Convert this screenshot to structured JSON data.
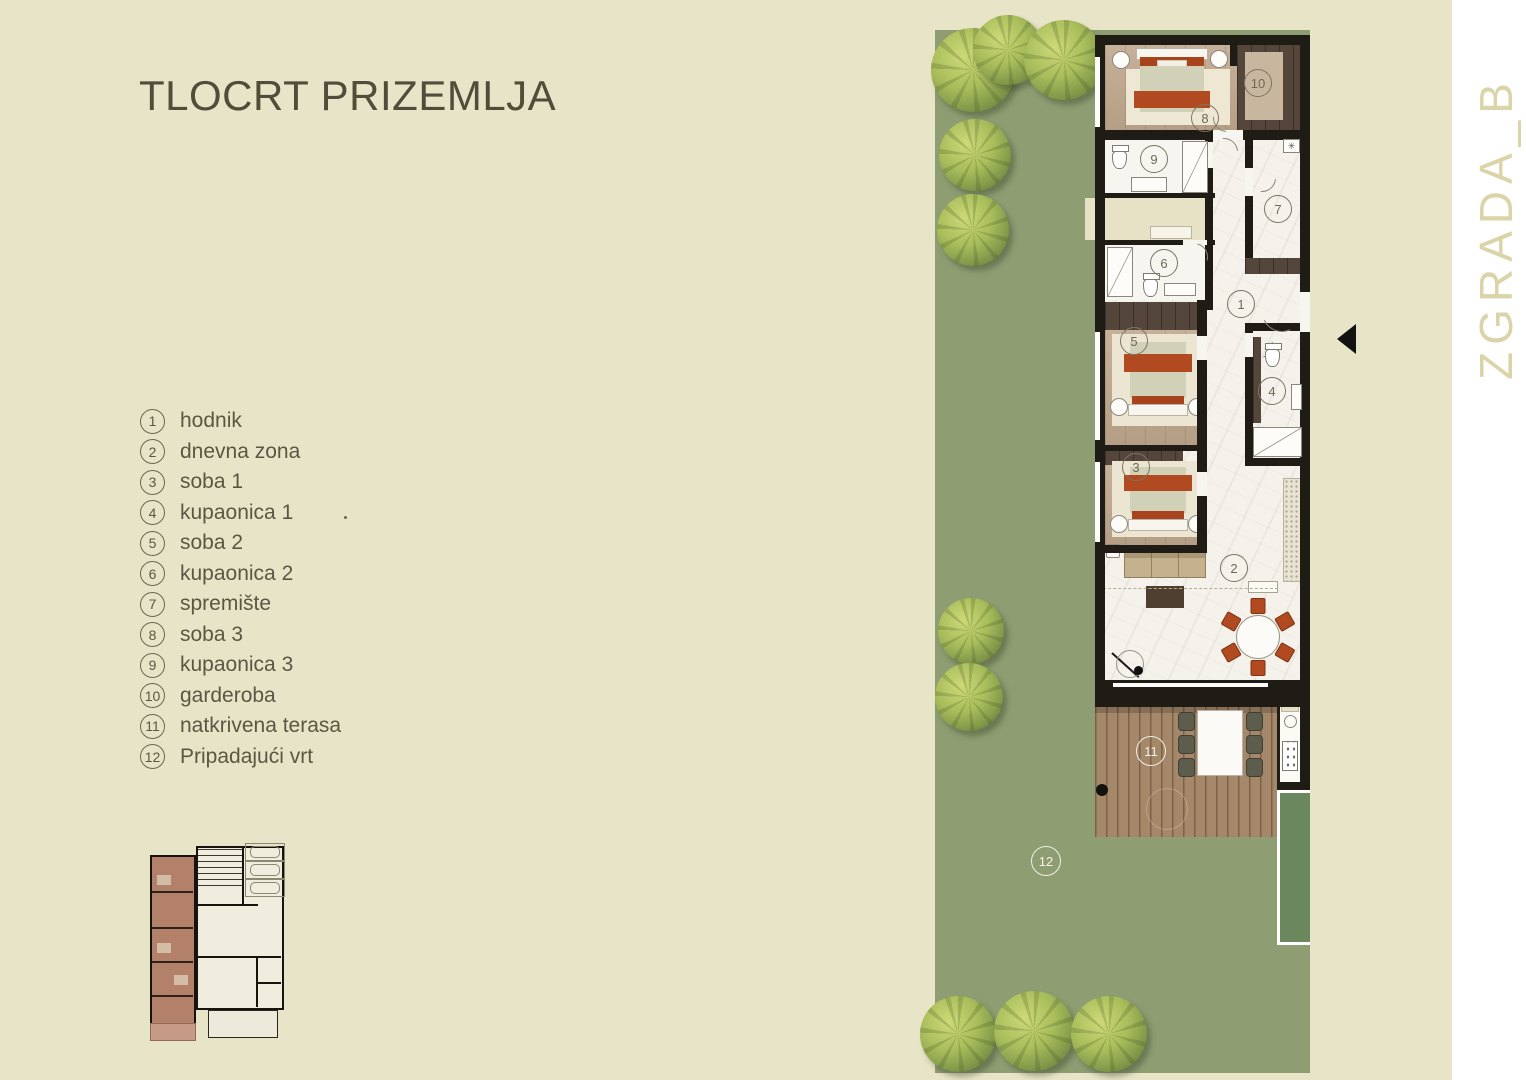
{
  "title": "TLOCRT PRIZEMLJA",
  "side_label": "ZGRADA_B",
  "legend": {
    "items": [
      {
        "num": "1",
        "label": "hodnik"
      },
      {
        "num": "2",
        "label": "dnevna zona"
      },
      {
        "num": "3",
        "label": "soba 1"
      },
      {
        "num": "4",
        "label": "kupaonica 1"
      },
      {
        "num": "5",
        "label": "soba 2"
      },
      {
        "num": "6",
        "label": "kupaonica 2"
      },
      {
        "num": "7",
        "label": "spremište"
      },
      {
        "num": "8",
        "label": "soba 3"
      },
      {
        "num": "9",
        "label": "kupaonica 3"
      },
      {
        "num": "10",
        "label": "garderoba"
      },
      {
        "num": "11",
        "label": "natkrivena terasa"
      },
      {
        "num": "12",
        "label": "Pripadajući vrt"
      }
    ]
  },
  "plan": {
    "washer_symbol": "✳",
    "markers": [
      {
        "num": "1",
        "variant": "olive",
        "x": 1227,
        "y": 290
      },
      {
        "num": "2",
        "variant": "olive",
        "x": 1220,
        "y": 554
      },
      {
        "num": "3",
        "variant": "olive",
        "x": 1122,
        "y": 453
      },
      {
        "num": "4",
        "variant": "olive",
        "x": 1258,
        "y": 377
      },
      {
        "num": "5",
        "variant": "olive",
        "x": 1120,
        "y": 327
      },
      {
        "num": "6",
        "variant": "olive",
        "x": 1150,
        "y": 249
      },
      {
        "num": "7",
        "variant": "olive",
        "x": 1264,
        "y": 195
      },
      {
        "num": "8",
        "variant": "olive",
        "x": 1191,
        "y": 104
      },
      {
        "num": "9",
        "variant": "olive",
        "x": 1140,
        "y": 145
      },
      {
        "num": "10",
        "variant": "olive",
        "x": 1244,
        "y": 69
      },
      {
        "num": "11",
        "variant": "white",
        "x": 1136,
        "y": 736
      },
      {
        "num": "12",
        "variant": "white",
        "x": 1031,
        "y": 846
      }
    ]
  },
  "colors": {
    "background": "#e8e4c7",
    "garden_green": "#8e9e72",
    "pool_green": "#6b875e",
    "wall_black": "#1f1c16",
    "accent_rust": "#b14a20",
    "wood_light": "#c0a88e",
    "wood_dark": "#54463a",
    "deck_brown": "#a5876a",
    "marble_white": "#f5f2ec",
    "text_olive": "#5b5744",
    "side_label_beige": "#dbd4a9"
  }
}
